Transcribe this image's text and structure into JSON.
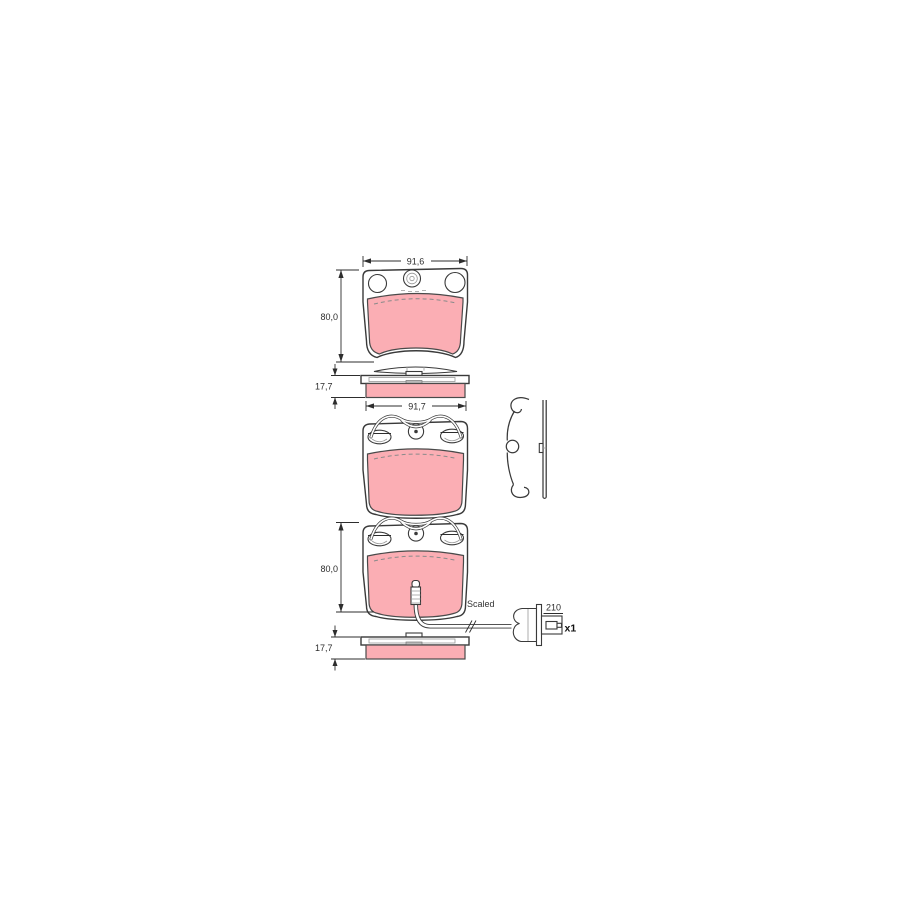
{
  "drawing": {
    "description": "Brake pad set engineering drawing with dimensions and wear sensor",
    "colors": {
      "friction_pink": "#FBAEB4",
      "outline_dark": "#3A3A3A",
      "detail_gray": "#9A9A9A",
      "background": "#FFFFFF"
    },
    "views": {
      "pad_front_top": {
        "width": "91,6",
        "height": "80,0"
      },
      "pad_edge_top": {
        "thickness": "17,7"
      },
      "pad_front_middle": {
        "width": "91,7"
      },
      "pad_front_bottom": {
        "height": "80,0"
      },
      "pad_edge_bottom": {
        "thickness": "17,7"
      },
      "wear_sensor": {
        "scale_note": "Scaled",
        "wire_length": "210",
        "quantity": "x1"
      }
    }
  }
}
